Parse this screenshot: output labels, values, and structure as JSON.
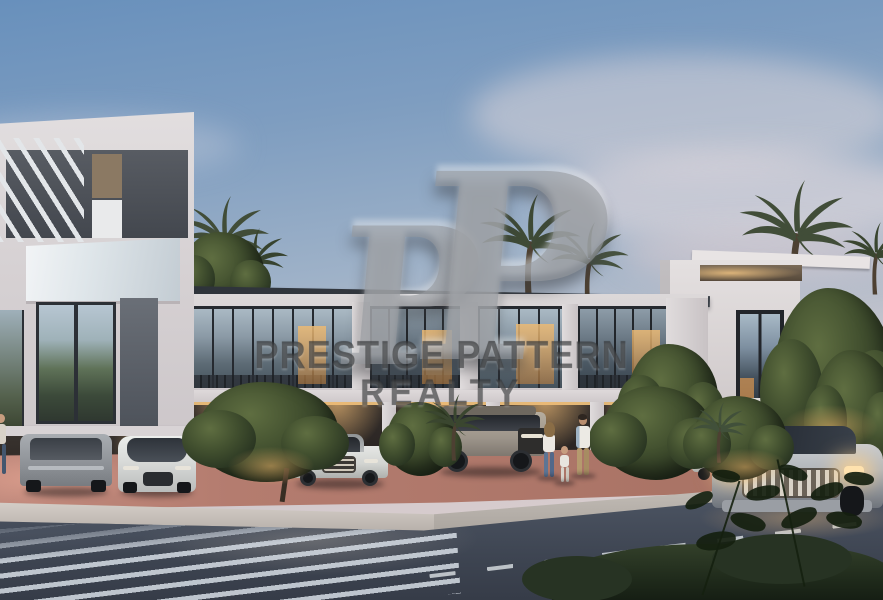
{
  "watermark": {
    "logo_left_letter": "P",
    "logo_right_letter": "P",
    "line1": "PRESTIGE PATTERN",
    "line2": "REALTY"
  },
  "scene": {
    "type": "real-estate architectural rendering",
    "time_of_day": "dusk",
    "description": "Modern white townhouse community at dusk: left three-storey villa with rooftop pergola and carport, long row of two-storey townhouses with warm-lit glazing, right villa with carport pergola, palm trees, ornamental bushes, red paver driveway, sidewalk with a family of three walking, street with crosswalk and dashed lane line, parked and driving SUVs, dark hedge in the foreground",
    "objects": [
      "left villa with pergola roof slats",
      "glass balcony",
      "townhouse row with floor-to-ceiling windows",
      "right villa with carport beam",
      "palm trees",
      "ornamental bushes",
      "grey SUV parked in carport",
      "white crossover parked in carport",
      "beige boxy off-road SUV",
      "white SUV in center driveway",
      "white SUV under right pergola",
      "silver SUV driving with headlights on",
      "family: woman, child, man",
      "pedestrian at left edge",
      "crosswalk stripes",
      "dashed lane line",
      "foreground hedge and leaf silhouettes"
    ]
  },
  "palette": {
    "sky_top": "#6890bc",
    "sky_horizon": "#decfd0",
    "facade_white": "#dcd8d9",
    "roof_dark": "#33383f",
    "glass_dusk": "#8fa3b5",
    "warm_window_light": "#e8b872",
    "paver_red": "#b47c6f",
    "road_asphalt": "#424a57",
    "crosswalk_stripe": "#d6dde5",
    "foliage_dark": "#27331f",
    "palm_frond": "#3c4733",
    "headlight_glow": "#ffe2ae",
    "watermark_gray": "#96999e"
  }
}
